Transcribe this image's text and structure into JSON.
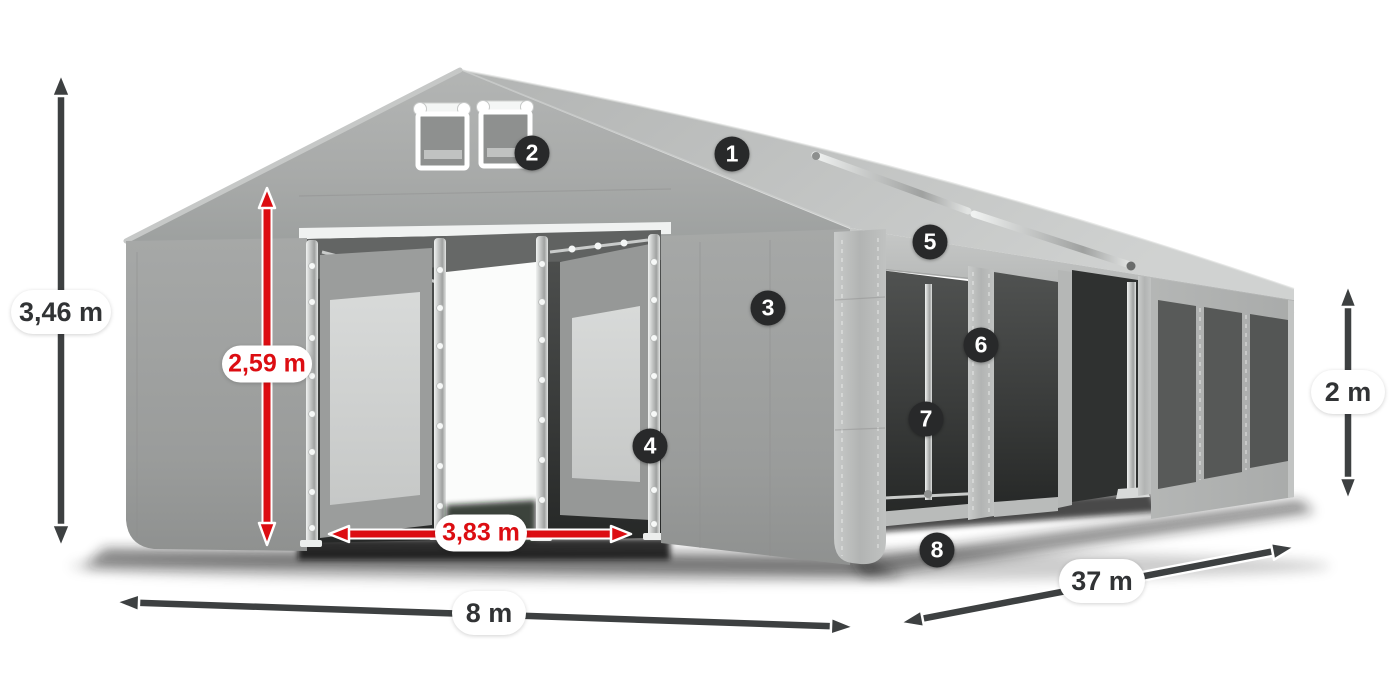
{
  "product_diagram": {
    "subject": "tent-structure-diagram",
    "dimension_labels": {
      "total_height": "3,46 m",
      "entrance_height": "2,59 m",
      "entrance_width": "3,83 m",
      "width": "8 m",
      "length": "37 m",
      "side_wall_height": "2 m"
    },
    "feature_markers": [
      "1",
      "2",
      "3",
      "4",
      "5",
      "6",
      "7",
      "8"
    ],
    "colors": {
      "background": "#ffffff",
      "accent_red": "#dc0d12",
      "arrow_dark": "#3d4041",
      "marker_bg": "#28292a",
      "marker_text": "#ffffff",
      "label_bg": "#ffffff",
      "label_text": "#313335",
      "tent_gray": "#a9abaa"
    }
  }
}
